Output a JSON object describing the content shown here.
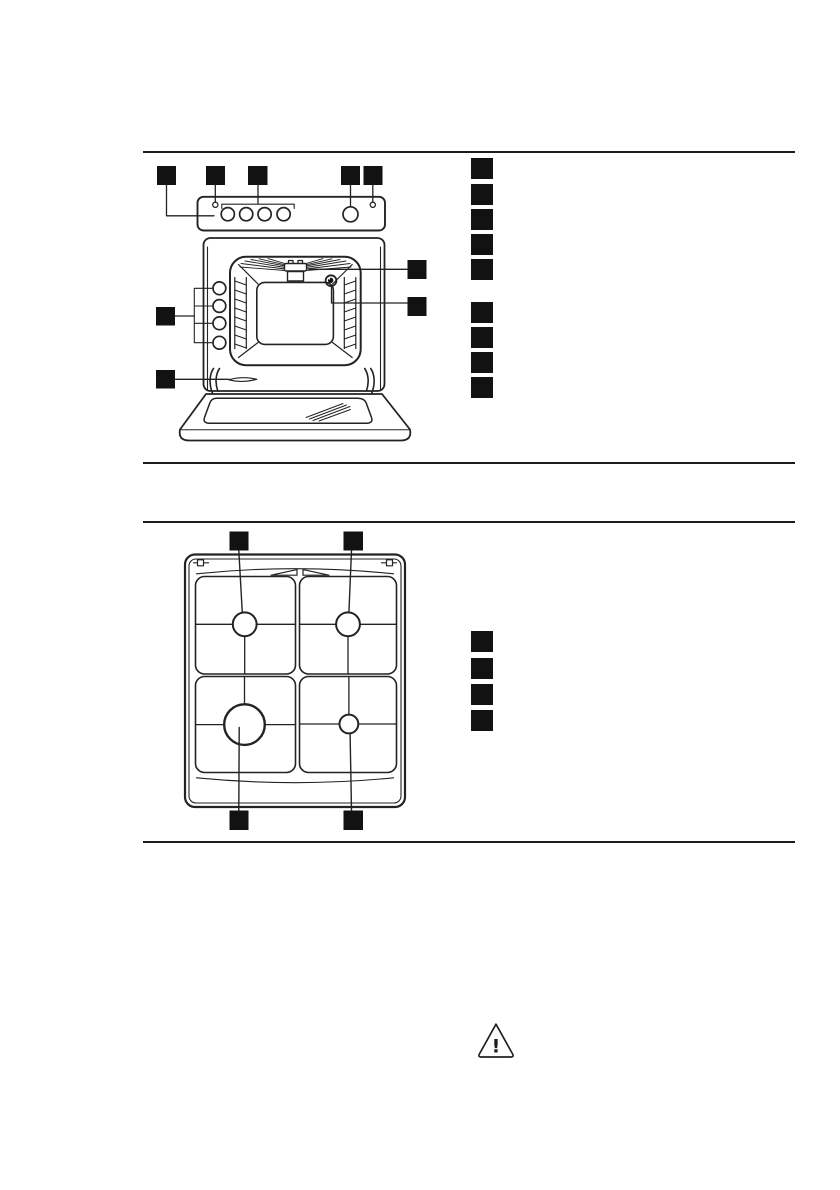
{
  "page": {
    "background": "#ffffff",
    "ink_color": "#232323",
    "marker_color": "#121212",
    "text_content": ""
  },
  "oven_section": {
    "diagram": "oven-front-view-line-art",
    "top_callout_markers": [
      "marker-1",
      "marker-2",
      "marker-3",
      "marker-4",
      "marker-5"
    ],
    "left_callout_markers": [
      "marker-shelf-levels",
      "marker-door-vent"
    ],
    "right_callout_markers": [
      "marker-grill-element",
      "marker-oven-lamp"
    ],
    "legend": {
      "group1_markers": [
        "item-1",
        "item-2",
        "item-3",
        "item-4",
        "item-5"
      ],
      "group2_markers": [
        "item-6",
        "item-7",
        "item-8",
        "item-9"
      ],
      "labels_visible": false
    }
  },
  "hob_section": {
    "diagram": "hob-top-view-line-art",
    "top_callout_markers": [
      "marker-left-burner",
      "marker-right-burner"
    ],
    "bottom_callout_markers": [
      "marker-large-burner",
      "marker-small-burner"
    ],
    "legend": {
      "markers": [
        "item-1",
        "item-2",
        "item-3",
        "item-4"
      ],
      "labels_visible": false
    }
  },
  "warning": {
    "icon": "warning-triangle-icon",
    "glyph": "!"
  }
}
